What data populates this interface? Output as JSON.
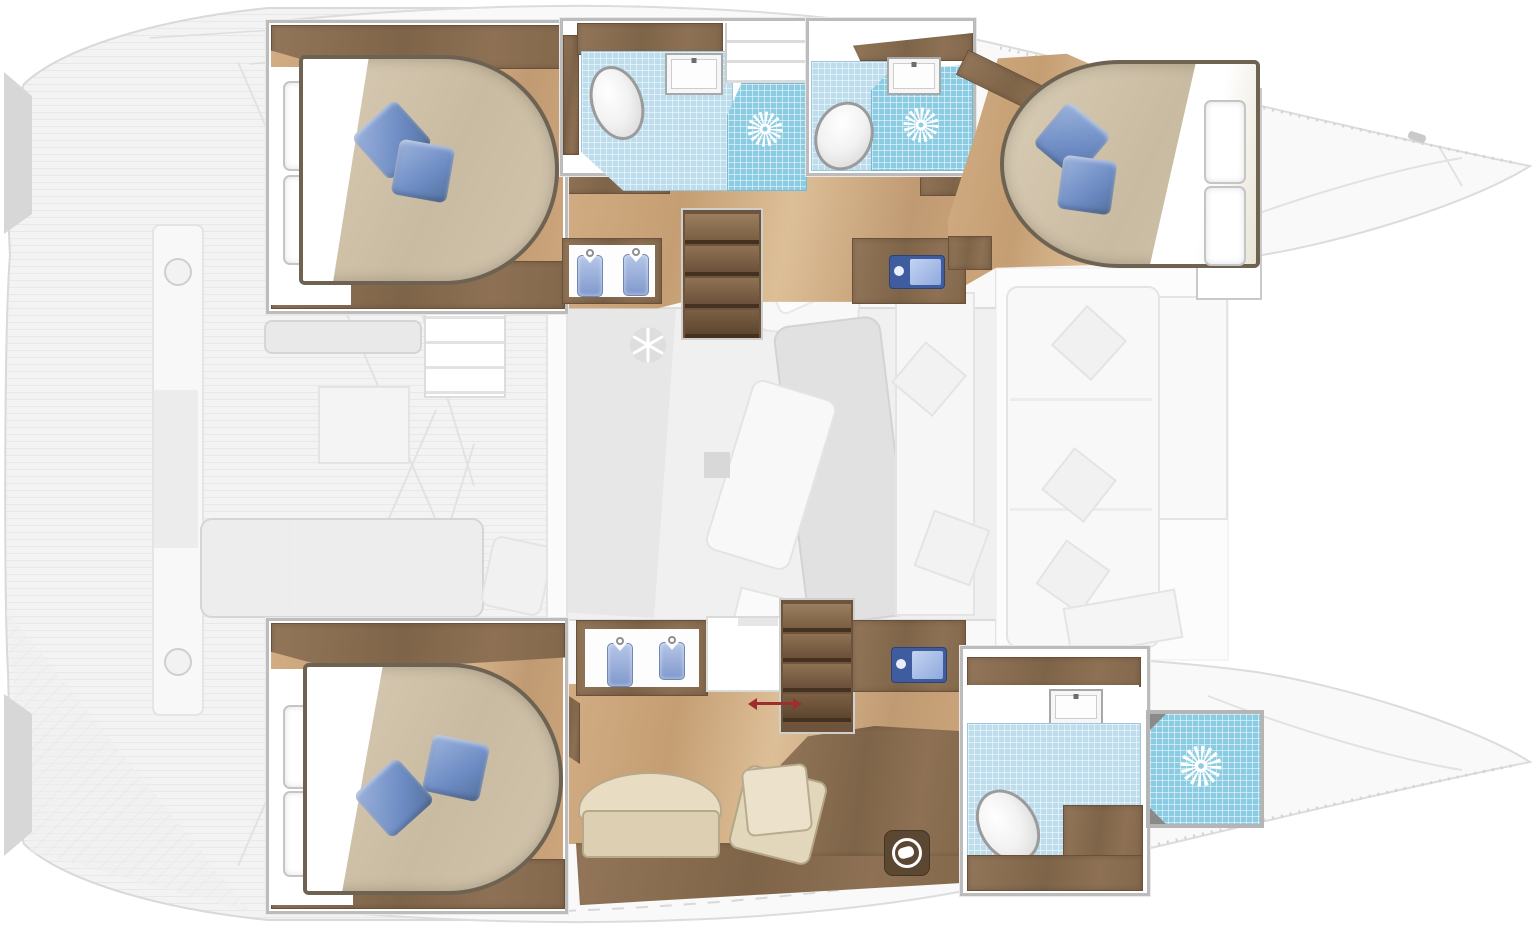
{
  "document": {
    "type": "catamaran-interior-floor-plan",
    "view": "top-down",
    "canvas": {
      "width": 1534,
      "height": 928
    },
    "visible_text": "none"
  },
  "palette": {
    "hull_outline": "#dcdcdc",
    "deck_ghost_fill": "#f3f3f3",
    "salon_ghost_fill": "#f0f0f0",
    "wood_floor": "#c9a277",
    "cabinet_brown": "#84684c",
    "bed_duvet": "#cfc1a9",
    "bed_border": "#6e6352",
    "pillow_blue": "#6d8cc4",
    "bathroom_tile": "#bddded",
    "shower_tile": "#8ccce2",
    "accent_arrow_red": "#9e2d2d",
    "tv_blue": "#3f5c9e",
    "icon_white": "#ffffff"
  },
  "hull_port_top": {
    "cabin_aft": {
      "bed": {
        "pillows": 2
      },
      "headboard_shelves": 2,
      "cabinet_strips": 2
    },
    "bathroom_aft": {
      "fixtures": [
        "toilet",
        "sink",
        "shower"
      ],
      "shower_icon": "sunburst",
      "companionway_steps": 2
    },
    "bathroom_fwd": {
      "fixtures": [
        "toilet",
        "sink",
        "shower"
      ],
      "shower_icon": "sunburst"
    },
    "wardrobe": {
      "hanging_shirts": 2
    },
    "stairs": {
      "treads": 4
    },
    "tv_cabinet": {
      "icon": "tv"
    },
    "cabin_fwd": {
      "bed": {
        "pillows": 2
      },
      "headboard_shelves": 2,
      "cabinet_strips": 2
    }
  },
  "hull_starboard_bottom": {
    "cabin_owner_aft": {
      "bed": {
        "pillows": 2
      },
      "headboard_shelves": 2,
      "cabinet_strips": 2
    },
    "wardrobe": {
      "hanging_shirts": 2
    },
    "stairs": {
      "treads": 4,
      "access_arrow": "red-double-headed"
    },
    "tv_cabinet": {
      "icon": "tv"
    },
    "lounge": {
      "bench_seat": 1,
      "ottoman_cushions": 2,
      "desk_surface": 1,
      "washing_machine": 1
    },
    "bathroom_fwd": {
      "fixtures": [
        "toilet",
        "sink"
      ]
    },
    "shower_stall_fwd": {
      "shower_icon": "sunburst"
    }
  },
  "deck_ghost": {
    "aft_cockpit": {
      "features": [
        "plank-deck",
        "center-beam",
        "beam-rings",
        "sunbed",
        "bench",
        "deck-pillow",
        "transom-wedges",
        "white-lockers",
        "entry-steps"
      ]
    },
    "salon": {
      "features": [
        "galley-counter",
        "refrigerator-snowflake",
        "dining-table",
        "chaise",
        "seat-cushion",
        "bench-with-pillows",
        "small-box"
      ]
    },
    "bow_cockpit": {
      "features": [
        "l-sofa",
        "diamond-pillows-3",
        "side-panels"
      ]
    },
    "bows": {
      "count": 2,
      "toe_rail": "dashed-ticks"
    }
  },
  "icons": {
    "sunburst_shower": 3,
    "snowflake_fridge": 1,
    "tv": 2,
    "hanging_shirt": 4,
    "washing_machine": 1,
    "red_access_arrow": 1
  }
}
